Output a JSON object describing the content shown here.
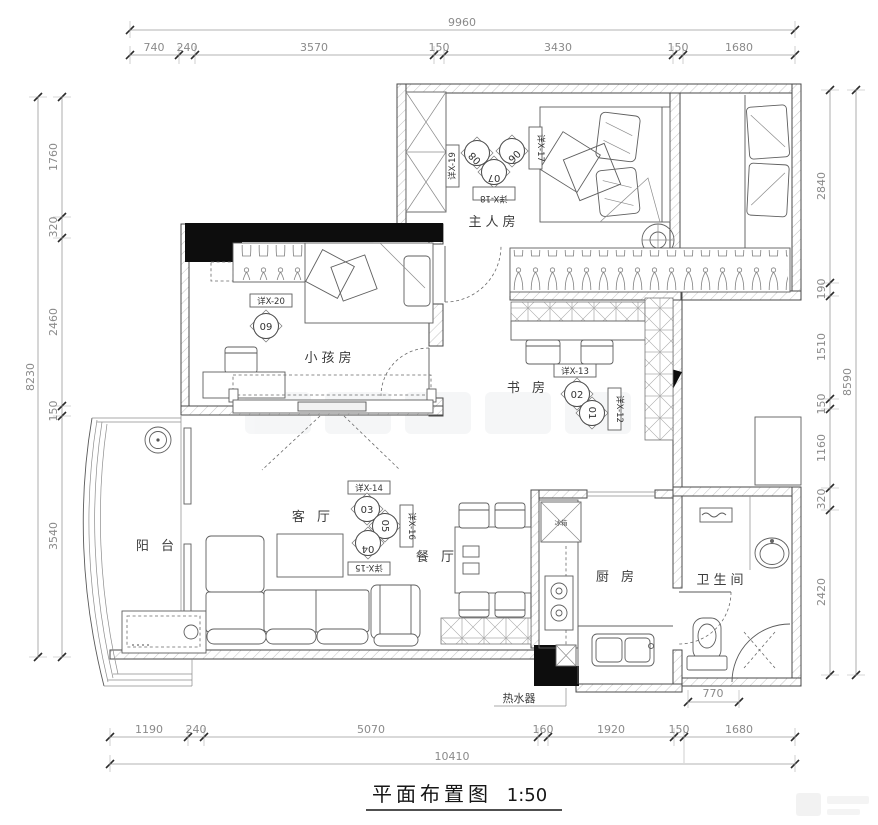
{
  "title": {
    "name": "平面布置图",
    "scale": "1:50"
  },
  "rooms": {
    "master": "主人房",
    "kids": "小孩房",
    "study": "书 房",
    "living": "客 厅",
    "dining": "餐 厅",
    "kitchen": "厨 房",
    "bath": "卫生间",
    "balcony": "阳 台"
  },
  "labels": {
    "water_heater": "热水器",
    "fridge": "冰箱"
  },
  "callouts": [
    {
      "num": "01",
      "ref": "详X-12"
    },
    {
      "num": "02",
      "ref": "详X-13"
    },
    {
      "num": "03",
      "ref": "详X-14"
    },
    {
      "num": "04",
      "ref": "详X-15"
    },
    {
      "num": "05",
      "ref": "详X-16"
    },
    {
      "num": "06",
      "ref": "详X-17"
    },
    {
      "num": "07",
      "ref": "详X-18"
    },
    {
      "num": "08",
      "ref": "详X-19"
    },
    {
      "num": "09",
      "ref": "详X-20"
    }
  ],
  "dims": {
    "top": {
      "total": "9960",
      "segments": [
        "740",
        "240",
        "3570",
        "150",
        "3430",
        "150",
        "1680"
      ]
    },
    "bottom": {
      "total": "10410",
      "segments": [
        "1190",
        "240",
        "5070",
        "160",
        "1920",
        "150",
        "1680"
      ]
    },
    "left": {
      "total": "8230",
      "segments": [
        "1760",
        "320",
        "2460",
        "150",
        "3540"
      ]
    },
    "right": {
      "total": "8590",
      "segments": [
        "2840",
        "190",
        "1510",
        "150",
        "1160",
        "320",
        "2420"
      ]
    },
    "bath_width": "770"
  }
}
